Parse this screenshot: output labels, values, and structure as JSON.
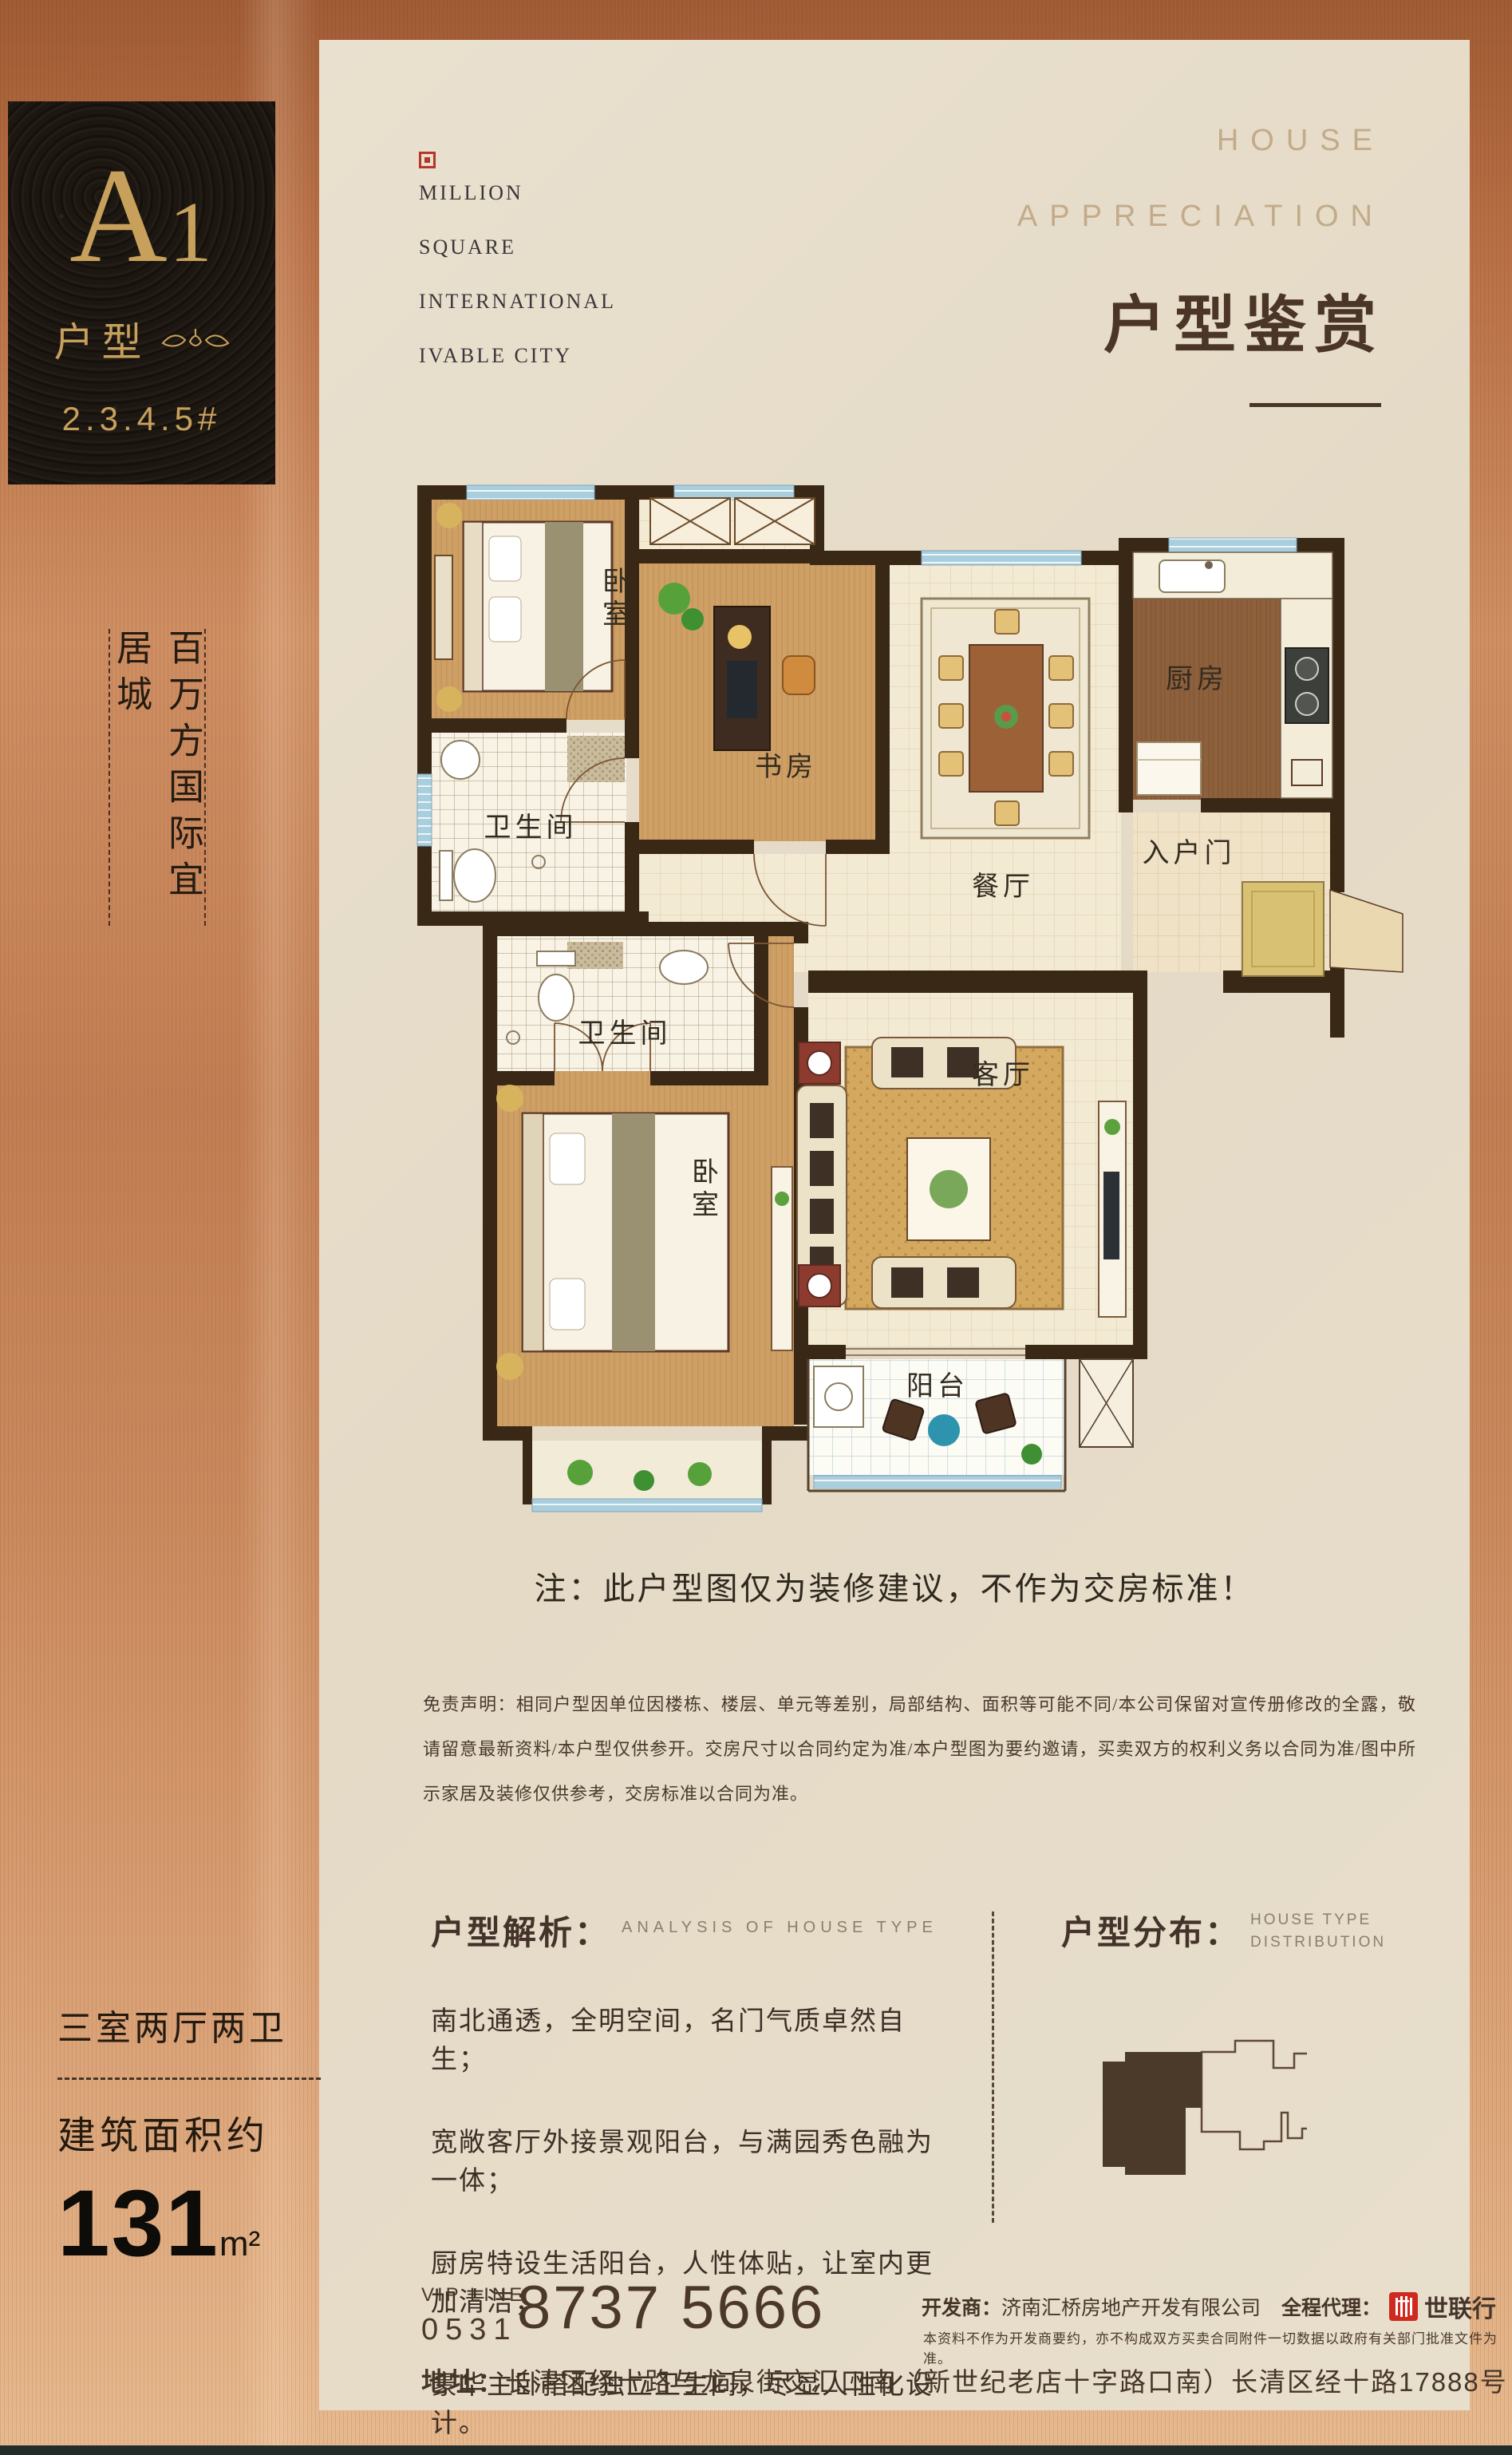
{
  "badge": {
    "unit_a": "A",
    "unit_1": "1",
    "label": "户型",
    "buildings": "2.3.4.5#"
  },
  "brand": {
    "lines": [
      "MILLION",
      "SQUARE",
      "INTERNATIONAL",
      "IVABLE CITY"
    ]
  },
  "header": {
    "en1": "HOUSE",
    "en2": "APPRECIATION",
    "title": "户型鉴赏"
  },
  "slogan": {
    "text": "百万方国际宜居城"
  },
  "floorplan": {
    "note": "注：此户型图仅为装修建议，不作为交房标准！",
    "rooms": {
      "bedroom1": "卧室",
      "study": "书房",
      "bath1": "卫生间",
      "dining": "餐厅",
      "kitchen": "厨房",
      "entry": "入户门",
      "living": "客厅",
      "bath2": "卫生间",
      "master": "卧室",
      "balcony": "阳台"
    }
  },
  "disclaimer": "免责声明：相同户型因单位因楼栋、楼层、单元等差别，局部结构、面积等可能不同/本公司保留对宣传册修改的全露，敬请留意最新资料/本户型仅供参开。交房尺寸以合同约定为准/本户型图为要约邀请，买卖双方的权利义务以合同为准/图中所示家居及装修仅供参考，交房标准以合同为准。",
  "analysis": {
    "title": "户型解析：",
    "subtitle": "ANALYSIS OF HOUSE TYPE",
    "points": [
      "南北通透，全明空间，名门气质卓然自生；",
      "宽敞客厅外接景观阳台，与满园秀色融为一体；",
      "厨房特设生活阳台，人性体贴，让室内更加清洁；",
      "豪华主卧搭配独立卫生间，尽显人性化设计。"
    ]
  },
  "distribution": {
    "title": "户型分布：",
    "subtitle1": "HOUSE TYPE",
    "subtitle2": "DISTRIBUTION"
  },
  "specs": {
    "layout": "三室两厅两卫",
    "area_label": "建筑面积约",
    "area_value": "131",
    "area_unit": "m²"
  },
  "contact": {
    "vip": "VIP LINE",
    "code": "0531",
    "phone": "8737 5666",
    "dev_label": "开发商：",
    "developer": "济南汇桥房地产开发有限公司",
    "agent_label": "全程代理：",
    "agent": "世联行",
    "legal": "本资料不作为开发商要约，亦不构成双方买卖合同附件一切数据以政府有关部门批准文件为准。",
    "addr_label": "地址：",
    "address": "长清区经十路与龙泉街交汇口南（新世纪老店十字路口南）长清区经十路17888号"
  },
  "colors": {
    "copper": "#c08157",
    "gold": "#c7a15c",
    "dark_brown": "#46352a",
    "red_square": "#b5352a",
    "agent_red": "#cf2a1f",
    "cream": "#e6dcc9"
  }
}
